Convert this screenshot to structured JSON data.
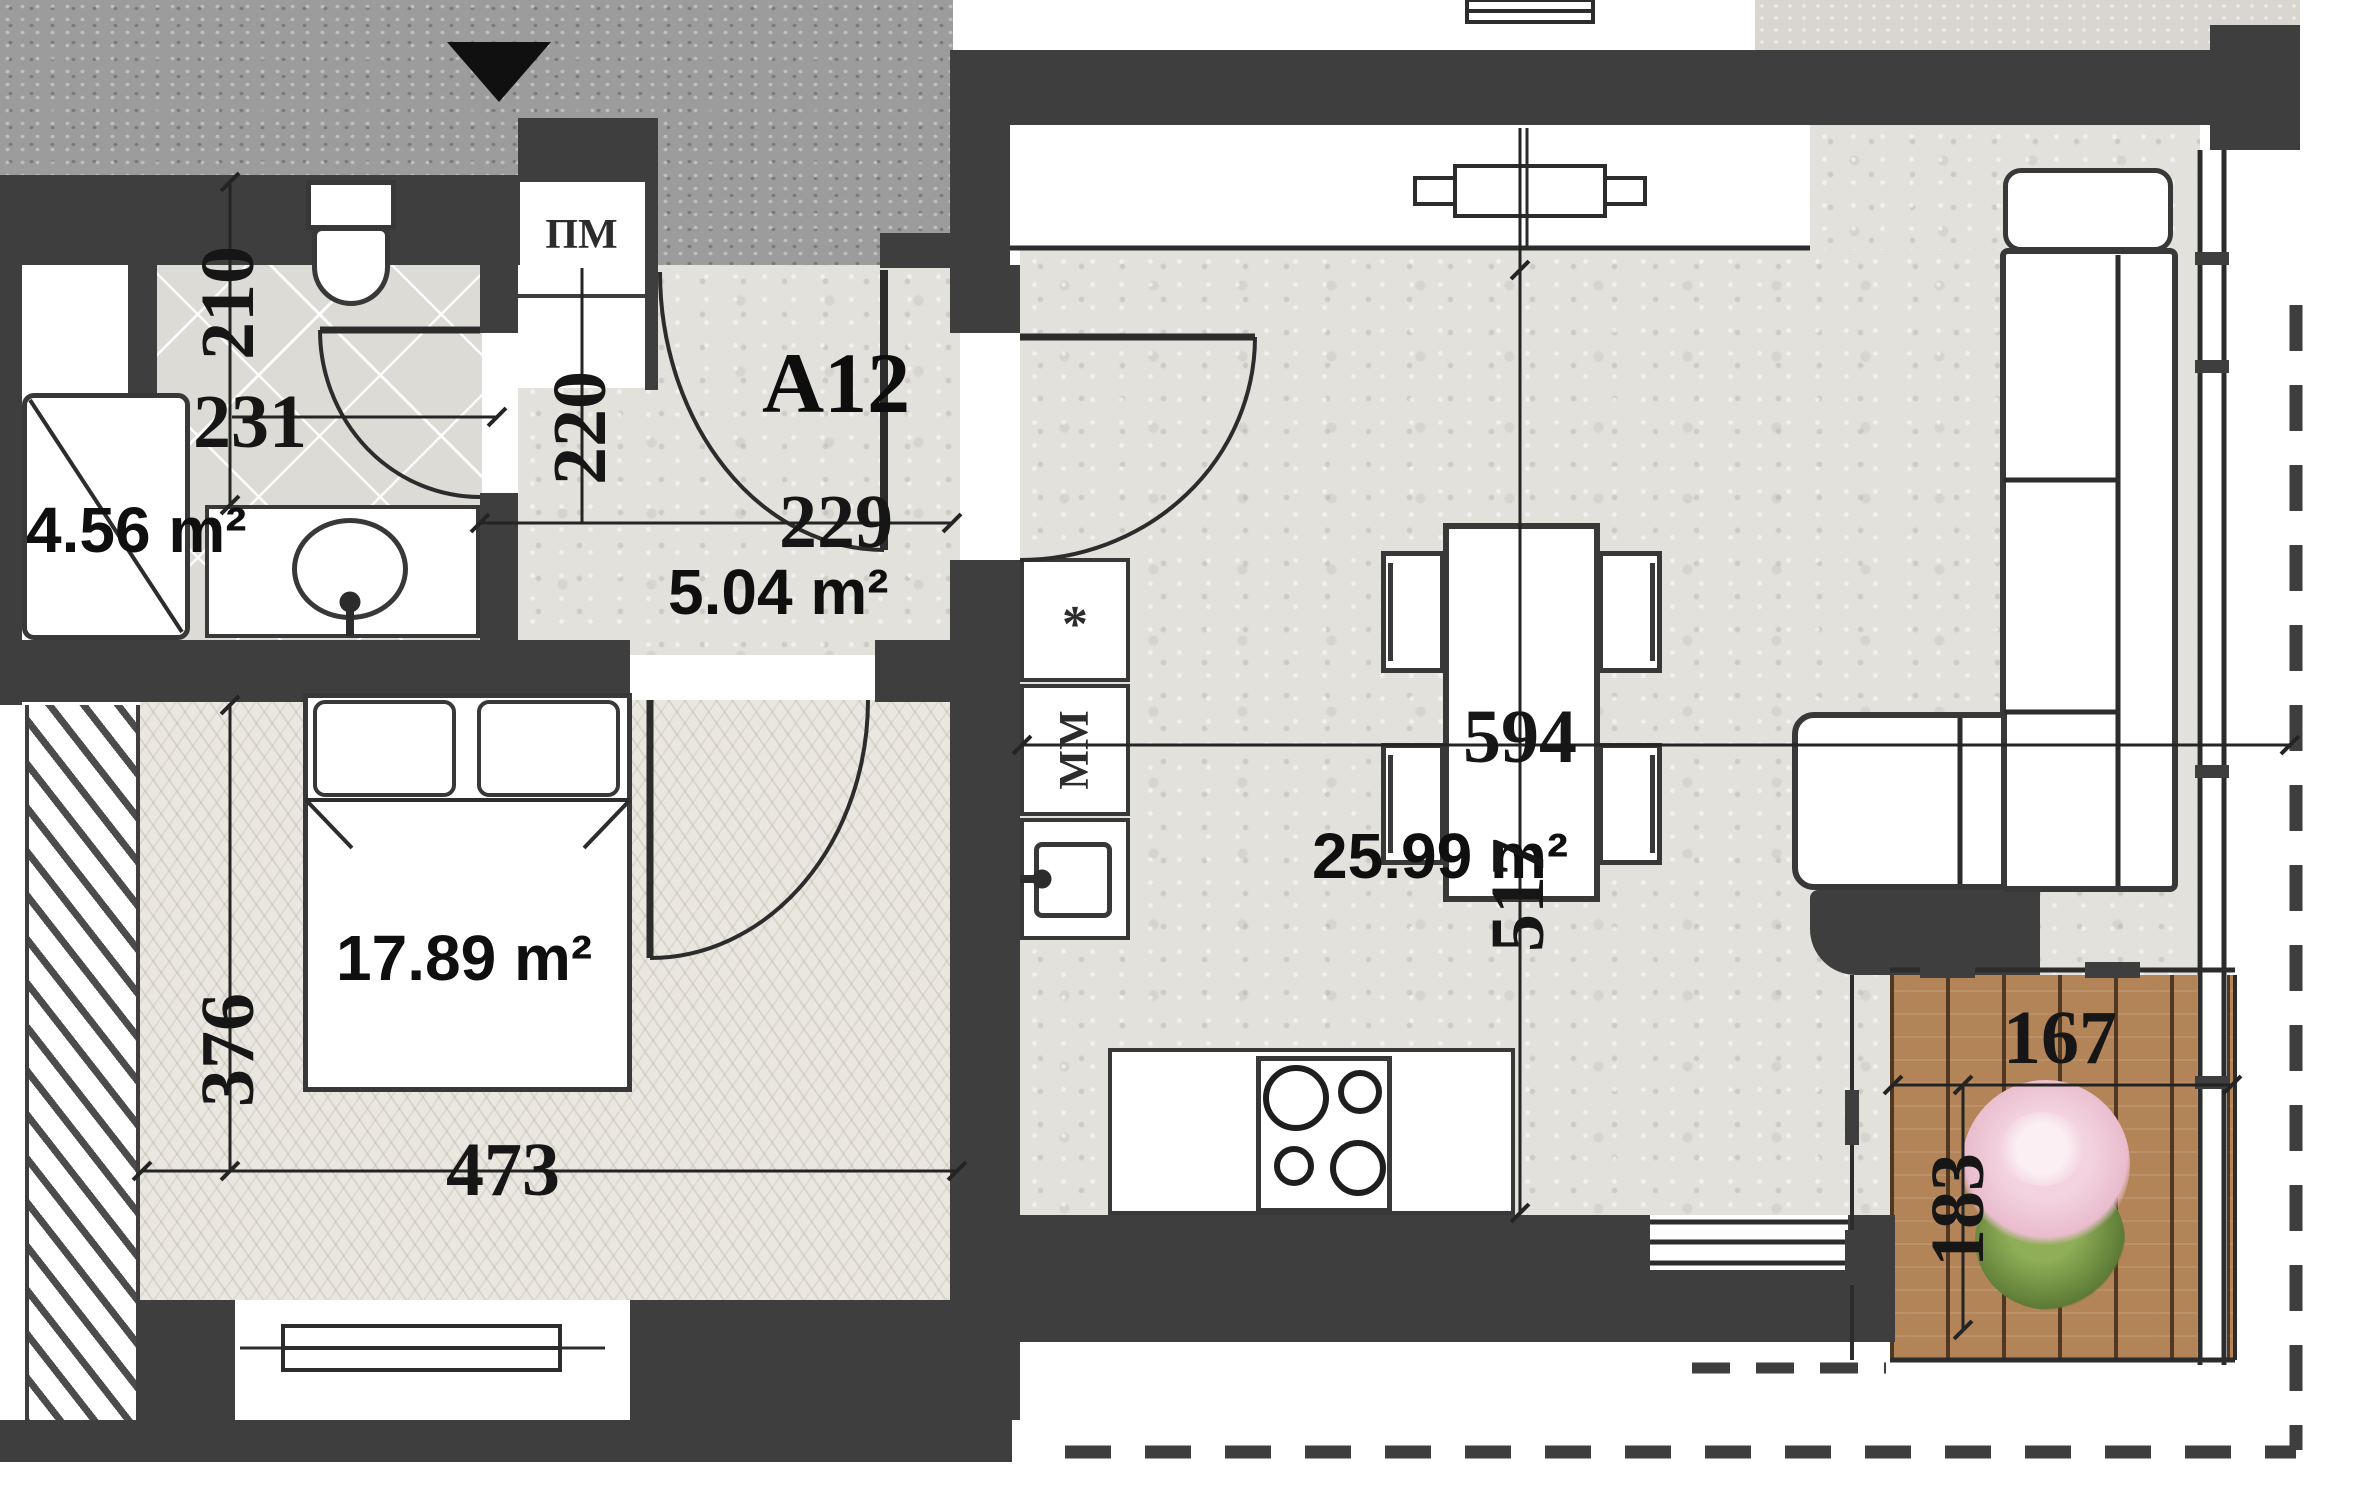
{
  "plan_title": "Apartment floor plan",
  "rooms": {
    "hall": {
      "code": "A12",
      "area": "5.04 m²",
      "width": "229",
      "depth": "220"
    },
    "bathroom": {
      "area": "4.56 m²",
      "width": "231",
      "depth": "210"
    },
    "bedroom": {
      "area": "17.89 m²",
      "width": "473",
      "depth": "376"
    },
    "living": {
      "area": "25.99 m²",
      "width": "594",
      "depth": "517"
    },
    "balcony": {
      "width": "167",
      "depth": "183"
    }
  },
  "fixtures": {
    "washing_machine": "ПМ",
    "dishwasher": "ММ",
    "cabinet_mark": "*"
  },
  "colors": {
    "wall": "#3e3e3e",
    "stair_lobby": "#9c9c9c",
    "floor_stone": "#e3e1dc",
    "floor_bedroom": "#eae7e1",
    "floor_tile": "#dddbd6",
    "deck_wood": "#b28458",
    "plant_pink": "#eec6d6",
    "plant_green": "#6f8f47"
  }
}
